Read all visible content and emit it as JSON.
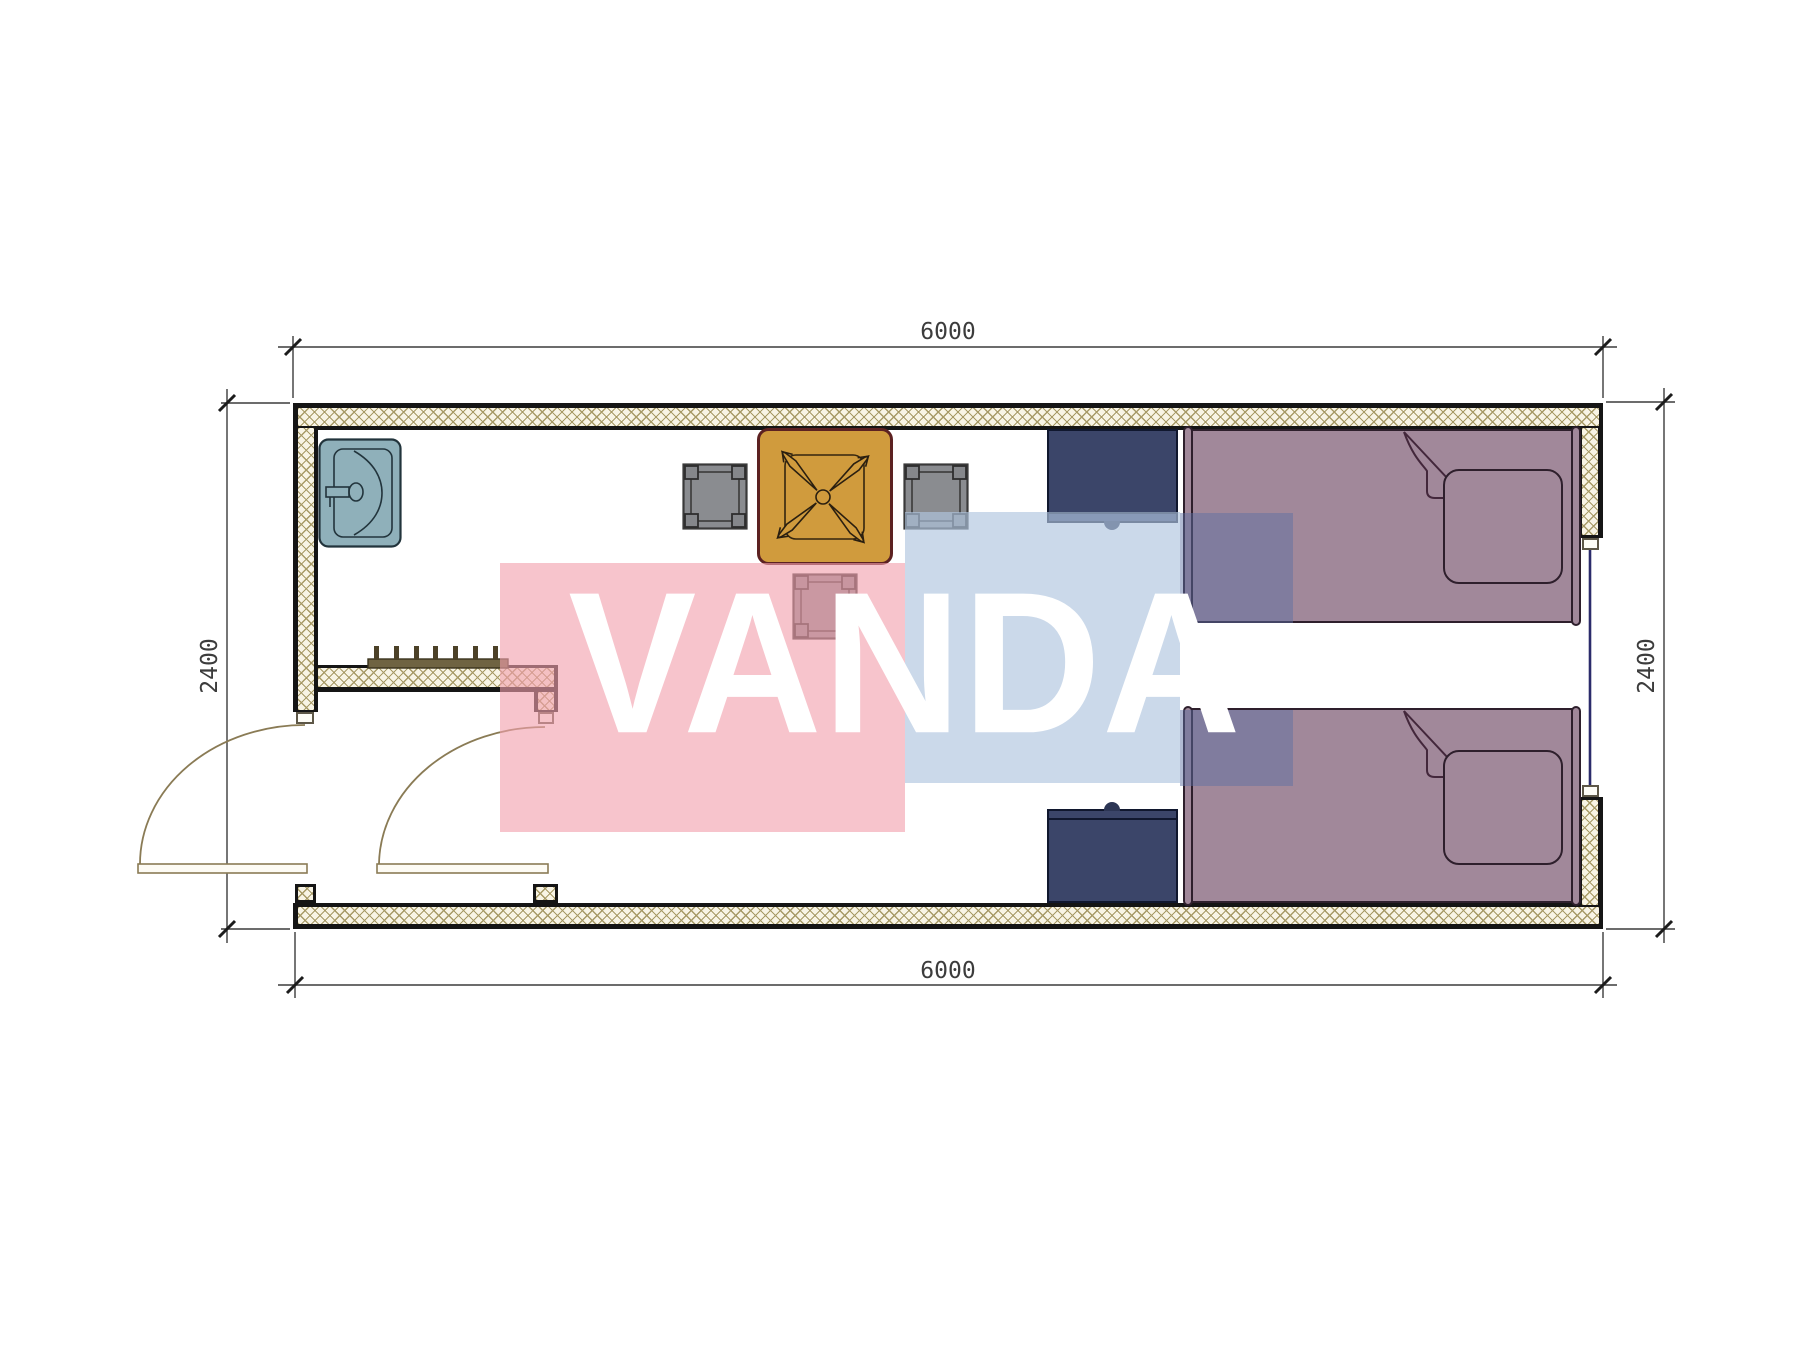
{
  "watermark": {
    "text": "VANDA",
    "pink_color": "#f2a0ad",
    "blue_color": "#b0c6df"
  },
  "dimensions": {
    "top": "6000",
    "bottom": "6000",
    "left": "2400",
    "right": "2400"
  },
  "palette": {
    "wall_fill": "#f8f4e5",
    "wall_hatch_line": "#a79a66",
    "wall_outline": "#151515",
    "dimension_line": "#3c3c3c",
    "sink": "#8fb0ba",
    "table": "#d09b3d",
    "table_border": "#5c2121",
    "stool": "#8a8c90",
    "nightstand": "#3b4569",
    "bed": "#a1889a",
    "door_line": "#8a7b55",
    "window_glass": "#2b2b6b"
  },
  "furniture": {
    "items": [
      {
        "name": "wash-basin"
      },
      {
        "name": "dining-table-with-fan-base"
      },
      {
        "name": "stool-left"
      },
      {
        "name": "stool-right"
      },
      {
        "name": "stool-bottom"
      },
      {
        "name": "nightstand-top"
      },
      {
        "name": "nightstand-bottom"
      },
      {
        "name": "single-bed-top"
      },
      {
        "name": "single-bed-bottom"
      },
      {
        "name": "coat-rack"
      }
    ]
  }
}
